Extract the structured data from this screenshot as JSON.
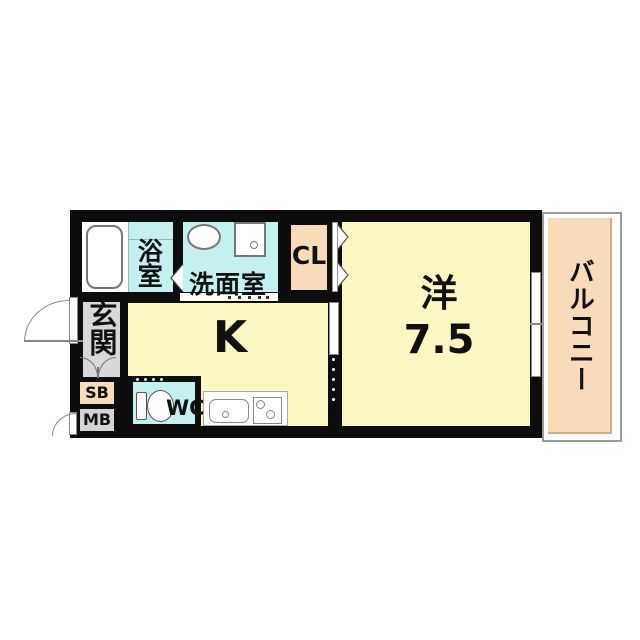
{
  "plan": {
    "rooms": {
      "bath": {
        "label": "浴室"
      },
      "washroom": {
        "label": "洗面室"
      },
      "closet": {
        "label": "CL"
      },
      "entrance": {
        "label": "玄関"
      },
      "shoe_box": {
        "label": "SB"
      },
      "meter_box": {
        "label": "MB"
      },
      "toilet": {
        "label": "WC"
      },
      "kitchen": {
        "label": "K"
      },
      "western_room": {
        "label": "洋",
        "size": "7.5"
      },
      "balcony": {
        "label": "バルコニー"
      }
    },
    "colors": {
      "room_yellow": "#FAF7C3",
      "room_cyan": "#C4F0EF",
      "room_peach": "#F8DCBA",
      "room_gray": "#D8D8D8",
      "wall": "#0D0D0D",
      "background": "#FFFFFF"
    }
  }
}
